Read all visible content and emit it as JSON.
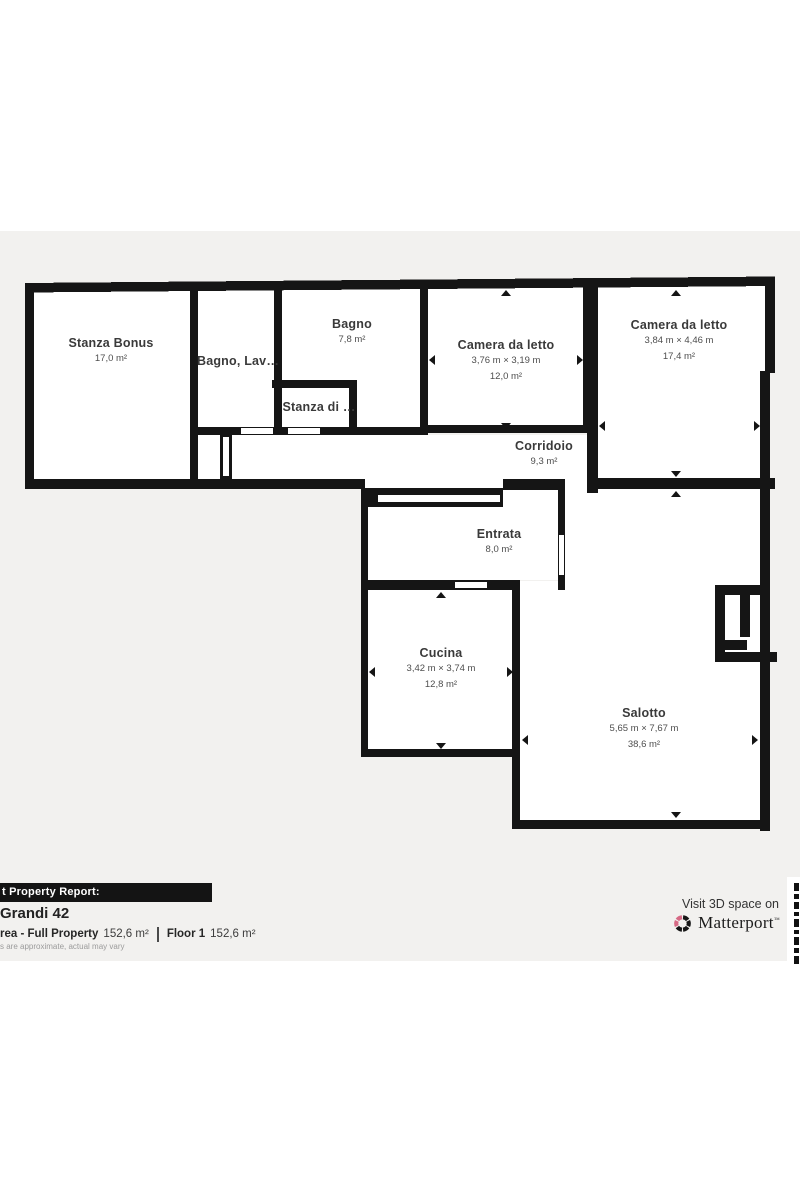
{
  "plan": {
    "rooms": [
      {
        "name": "Stanza Bonus",
        "area": "17,0 m²"
      },
      {
        "name": "Bagno, Lav…"
      },
      {
        "name": "Bagno",
        "area": "7,8 m²"
      },
      {
        "name": "Stanza di …"
      },
      {
        "name": "Camera da letto",
        "dims": "3,76 m × 3,19 m",
        "area": "12,0 m²"
      },
      {
        "name": "Camera da letto",
        "dims": "3,84 m × 4,46 m",
        "area": "17,4 m²"
      },
      {
        "name": "Corridoio",
        "area": "9,3 m²"
      },
      {
        "name": "Entrata",
        "area": "8,0 m²"
      },
      {
        "name": "Cucina",
        "dims": "3,42 m × 3,74 m",
        "area": "12,8 m²"
      },
      {
        "name": "Salotto",
        "dims": "5,65 m × 7,67 m",
        "area": "38,6 m²"
      }
    ],
    "colors": {
      "wall": "#151515",
      "plan_background": "#f2f1ef",
      "room_fill": "#ffffff",
      "brand_pink": "#d66a85"
    }
  },
  "footer": {
    "report_bar": "t Property Report:",
    "address": "Grandi 42",
    "total_area_label": "rea - Full Property",
    "total_area_value": "152,6 m²",
    "floor_label": "Floor 1",
    "floor_value": "152,6 m²",
    "disclaimer": "s are approximate, actual may vary",
    "visit_text": "Visit 3D space on",
    "brand": "Matterport",
    "trademark": "™"
  }
}
